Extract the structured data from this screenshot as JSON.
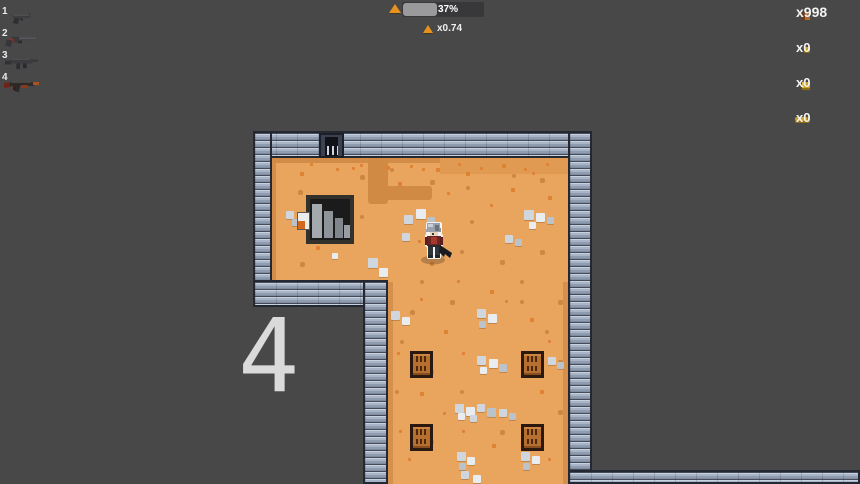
{
  "hud": {
    "weapon_slots": [
      {
        "number": "1",
        "weapon": "pistol"
      },
      {
        "number": "2",
        "weapon": "revolver"
      },
      {
        "number": "3",
        "weapon": "smg"
      },
      {
        "number": "4",
        "weapon": "assault-rifle"
      }
    ],
    "reload_bar": {
      "percent_text": "37%",
      "percent": 42,
      "multiplier_text": "x0.74"
    },
    "ammo_counters": [
      {
        "count_text": "x998",
        "ammo_type": "pistol-rounds"
      },
      {
        "count_text": "x0",
        "ammo_type": "light-rounds"
      },
      {
        "count_text": "x0",
        "ammo_type": "medium-rounds"
      },
      {
        "count_text": "x0",
        "ammo_type": "heavy-rounds"
      }
    ]
  },
  "overlay": {
    "level_number": "4"
  },
  "map": {
    "crates": [
      [
        410,
        351
      ],
      [
        521,
        351
      ],
      [
        410,
        424
      ],
      [
        521,
        424
      ]
    ],
    "pebbles": [
      [
        368,
        258,
        10,
        0
      ],
      [
        379,
        268,
        9,
        1
      ],
      [
        332,
        253,
        6,
        1
      ],
      [
        286,
        211,
        8,
        0
      ],
      [
        292,
        219,
        7,
        2
      ],
      [
        404,
        215,
        9,
        0
      ],
      [
        416,
        209,
        10,
        1
      ],
      [
        427,
        217,
        8,
        2
      ],
      [
        402,
        233,
        8,
        0
      ],
      [
        524,
        210,
        10,
        0
      ],
      [
        536,
        213,
        9,
        1
      ],
      [
        547,
        217,
        7,
        2
      ],
      [
        529,
        222,
        7,
        1
      ],
      [
        505,
        235,
        8,
        0
      ],
      [
        515,
        239,
        7,
        2
      ],
      [
        391,
        311,
        9,
        0
      ],
      [
        402,
        317,
        8,
        1
      ],
      [
        477,
        309,
        9,
        0
      ],
      [
        488,
        314,
        9,
        1
      ],
      [
        479,
        321,
        7,
        2
      ],
      [
        477,
        356,
        9,
        0
      ],
      [
        489,
        359,
        9,
        1
      ],
      [
        499,
        364,
        8,
        2
      ],
      [
        480,
        367,
        7,
        1
      ],
      [
        548,
        357,
        8,
        0
      ],
      [
        557,
        362,
        7,
        2
      ],
      [
        455,
        404,
        9,
        0
      ],
      [
        466,
        407,
        9,
        1
      ],
      [
        477,
        404,
        8,
        0
      ],
      [
        487,
        408,
        9,
        2
      ],
      [
        458,
        413,
        7,
        1
      ],
      [
        499,
        409,
        8,
        0
      ],
      [
        509,
        413,
        7,
        2
      ],
      [
        470,
        415,
        7,
        0
      ],
      [
        457,
        452,
        9,
        0
      ],
      [
        467,
        457,
        8,
        1
      ],
      [
        459,
        463,
        7,
        2
      ],
      [
        521,
        452,
        9,
        0
      ],
      [
        532,
        456,
        8,
        1
      ],
      [
        523,
        463,
        7,
        2
      ],
      [
        461,
        471,
        8,
        0
      ],
      [
        473,
        475,
        8,
        1
      ]
    ],
    "dots": [
      [
        300,
        172,
        4,
        0
      ],
      [
        352,
        167,
        3,
        0
      ],
      [
        398,
        182,
        4,
        0
      ],
      [
        422,
        168,
        3,
        0
      ],
      [
        447,
        192,
        3,
        0
      ],
      [
        466,
        172,
        4,
        0
      ],
      [
        490,
        204,
        3,
        0
      ],
      [
        511,
        188,
        4,
        0
      ],
      [
        532,
        172,
        3,
        0
      ],
      [
        548,
        196,
        4,
        0
      ],
      [
        310,
        163,
        3,
        0
      ],
      [
        336,
        168,
        3,
        0
      ],
      [
        360,
        164,
        3,
        0
      ],
      [
        386,
        166,
        4,
        0
      ],
      [
        410,
        165,
        3,
        0
      ],
      [
        436,
        168,
        4,
        0
      ],
      [
        458,
        163,
        3,
        0
      ],
      [
        480,
        167,
        3,
        0
      ],
      [
        502,
        164,
        4,
        0
      ],
      [
        524,
        168,
        3,
        0
      ],
      [
        546,
        163,
        3,
        0
      ],
      [
        316,
        246,
        4,
        0
      ],
      [
        345,
        200,
        3,
        0
      ],
      [
        372,
        290,
        4,
        0
      ],
      [
        420,
        298,
        3,
        0
      ],
      [
        444,
        330,
        4,
        0
      ],
      [
        462,
        352,
        3,
        0
      ],
      [
        530,
        318,
        4,
        0
      ],
      [
        548,
        340,
        3,
        0
      ],
      [
        420,
        392,
        4,
        0
      ],
      [
        443,
        412,
        3,
        0
      ],
      [
        540,
        390,
        4,
        0
      ],
      [
        462,
        430,
        3,
        0
      ],
      [
        540,
        432,
        4,
        0
      ],
      [
        408,
        458,
        3,
        0
      ],
      [
        548,
        458,
        3,
        0
      ],
      [
        492,
        444,
        4,
        0
      ],
      [
        397,
        352,
        3,
        0
      ],
      [
        399,
        430,
        3,
        0
      ],
      [
        490,
        290,
        4,
        0
      ],
      [
        505,
        300,
        3,
        0
      ],
      [
        457,
        280,
        3,
        0
      ],
      [
        430,
        262,
        4,
        0
      ],
      [
        418,
        240,
        3,
        0
      ],
      [
        298,
        190,
        5,
        1
      ],
      [
        340,
        230,
        5,
        1
      ],
      [
        360,
        215,
        4,
        1
      ],
      [
        300,
        262,
        5,
        1
      ],
      [
        330,
        200,
        4,
        1
      ],
      [
        430,
        180,
        5,
        1
      ],
      [
        470,
        220,
        4,
        1
      ],
      [
        540,
        250,
        5,
        1
      ],
      [
        460,
        250,
        4,
        1
      ],
      [
        500,
        260,
        5,
        1
      ],
      [
        420,
        280,
        4,
        1
      ],
      [
        450,
        300,
        5,
        1
      ],
      [
        520,
        280,
        4,
        1
      ],
      [
        558,
        300,
        5,
        1
      ],
      [
        400,
        340,
        4,
        1
      ],
      [
        558,
        360,
        5,
        1
      ],
      [
        430,
        370,
        4,
        1
      ],
      [
        558,
        410,
        5,
        1
      ],
      [
        430,
        440,
        4,
        1
      ],
      [
        500,
        430,
        5,
        1
      ],
      [
        460,
        390,
        4,
        1
      ],
      [
        395,
        390,
        4,
        1
      ],
      [
        545,
        330,
        4,
        1
      ],
      [
        410,
        310,
        5,
        1
      ],
      [
        520,
        300,
        4,
        1
      ],
      [
        360,
        175,
        5,
        1
      ],
      [
        390,
        168,
        4,
        1
      ],
      [
        540,
        178,
        5,
        1
      ],
      [
        466,
        186,
        4,
        1
      ],
      [
        512,
        174,
        4,
        1
      ]
    ],
    "colors": {
      "background": "#484848",
      "floor": "#e9a45e",
      "dirt": "#d18a44",
      "wall_light": "#c7d2e0",
      "wall_mid": "#9fabbe",
      "wall_seam": "#454b58",
      "accent_orange": "#e8921e",
      "ammo_gold": "#c9a22a",
      "crate_brown": "#b5702f"
    }
  }
}
